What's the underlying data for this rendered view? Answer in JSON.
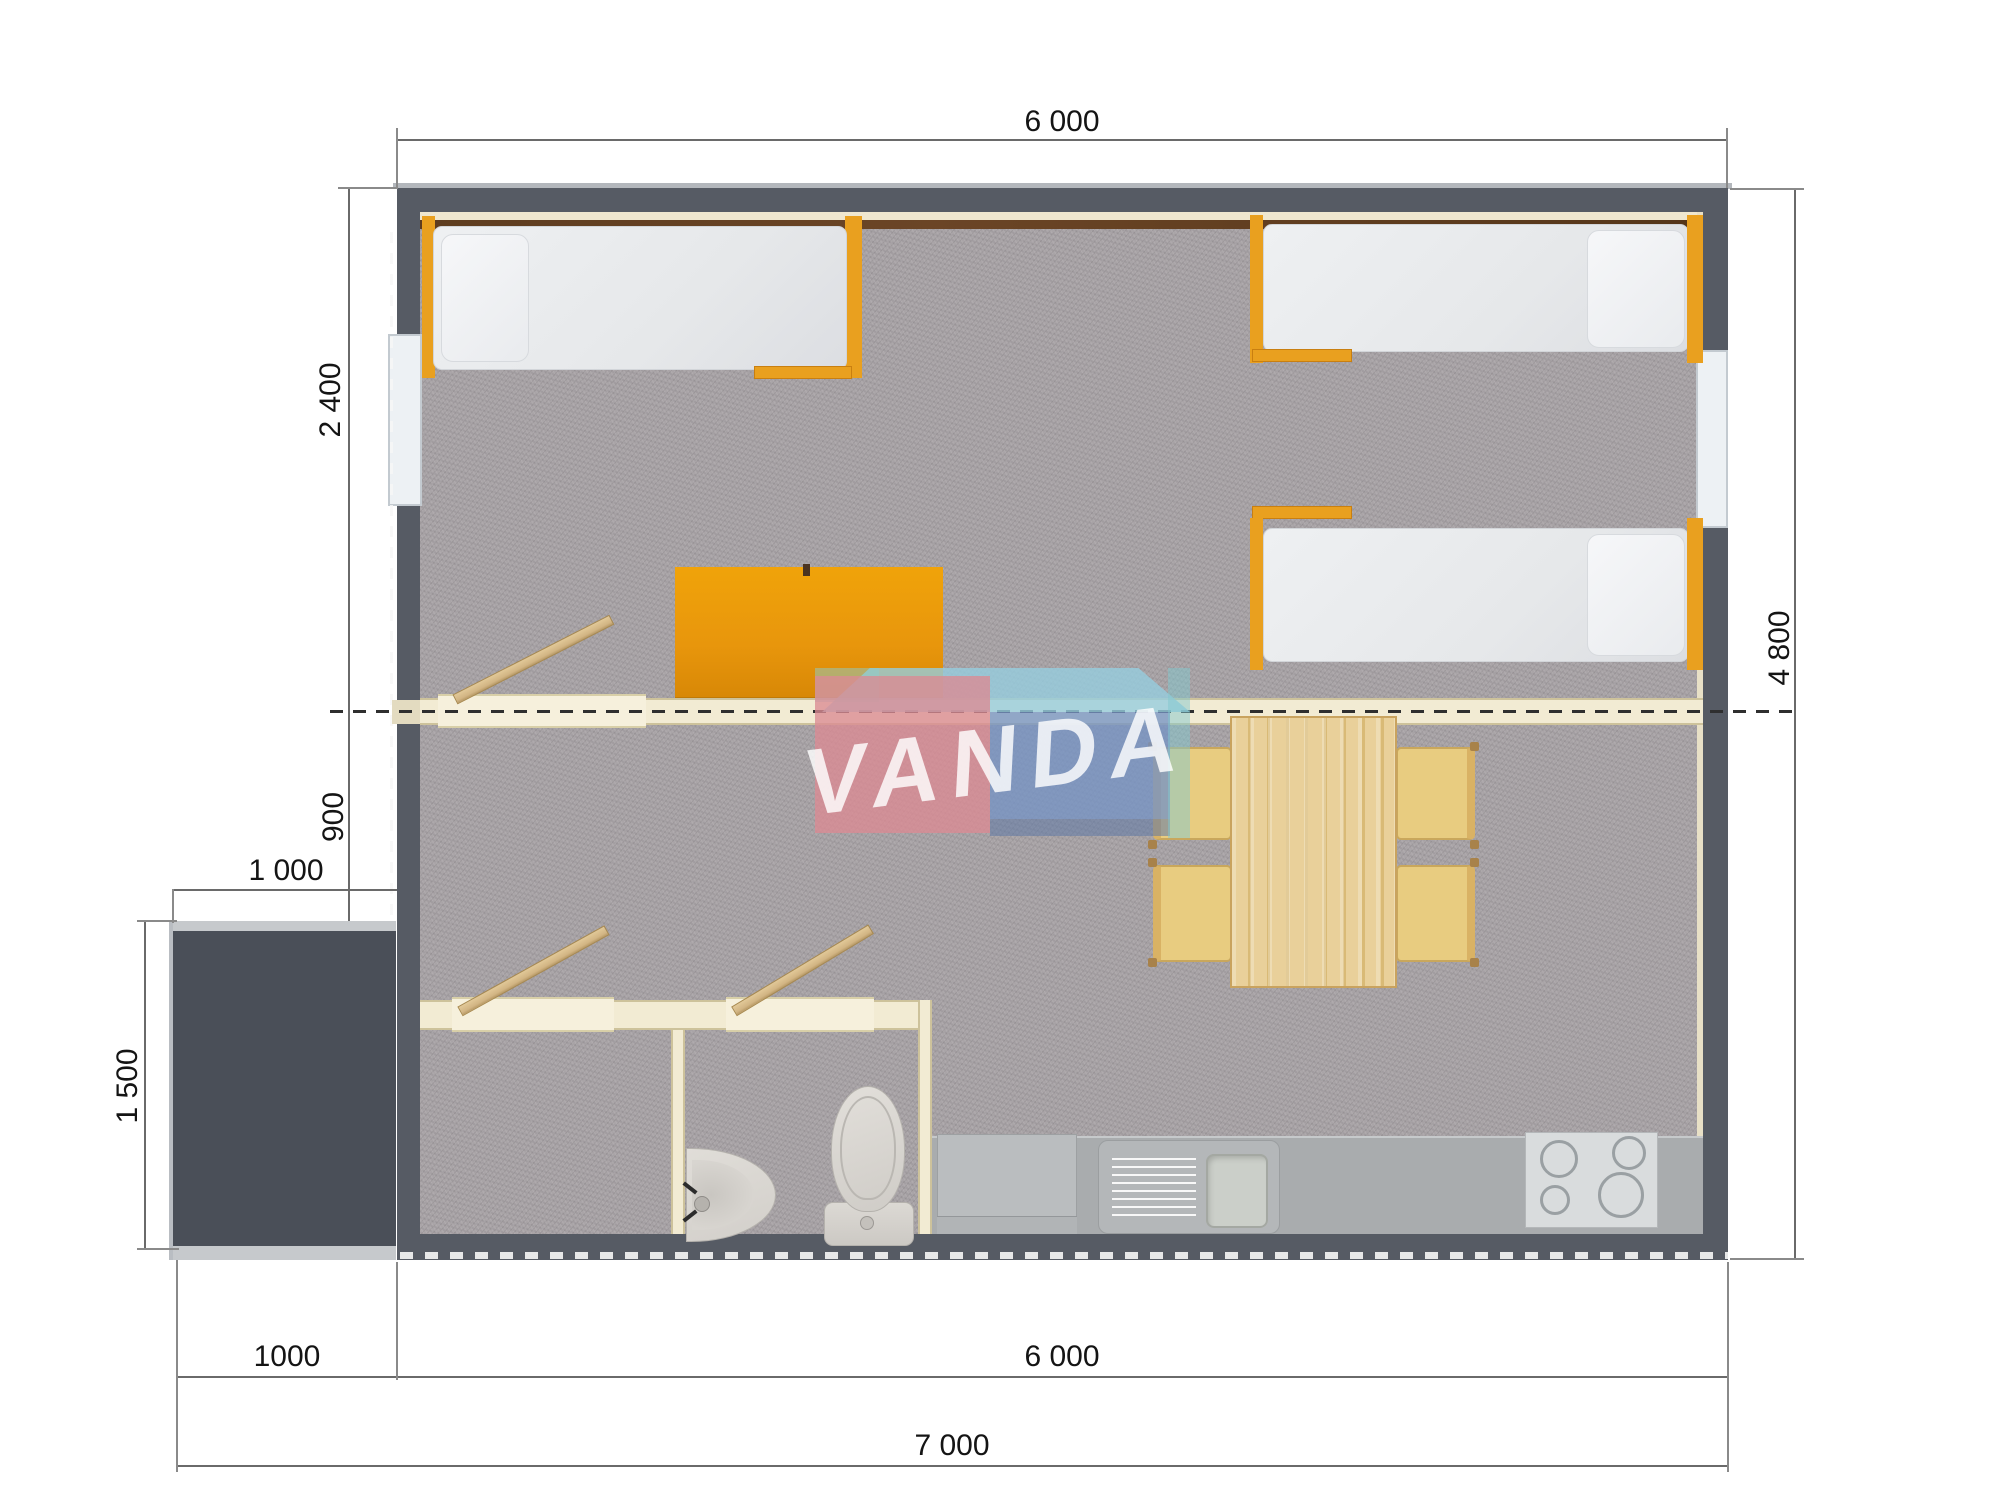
{
  "watermark": {
    "text": "VANDA"
  },
  "dimensions": {
    "top_width": "6 000",
    "right_height": "4 800",
    "bedroom_depth": "2 400",
    "hall_depth": "900",
    "porch_width": "1 000",
    "porch_depth": "1 500",
    "bottom_porch_width": "1000",
    "bottom_body_width": "6 000",
    "bottom_total_width": "7 000"
  },
  "colors": {
    "wall_dark": "#565b64",
    "wall_inner_cream": "#f2ebd3",
    "accent_orange": "#ec9a07",
    "carpet_gray": "#a9a4a7",
    "counter_gray": "#a9acae",
    "wood": "#e8cd90",
    "logo_pink": "#dd8f98",
    "logo_blue": "#7d9ac6",
    "logo_blue_top": "#9ccbdf",
    "logo_teal": "#8fc9cb"
  }
}
